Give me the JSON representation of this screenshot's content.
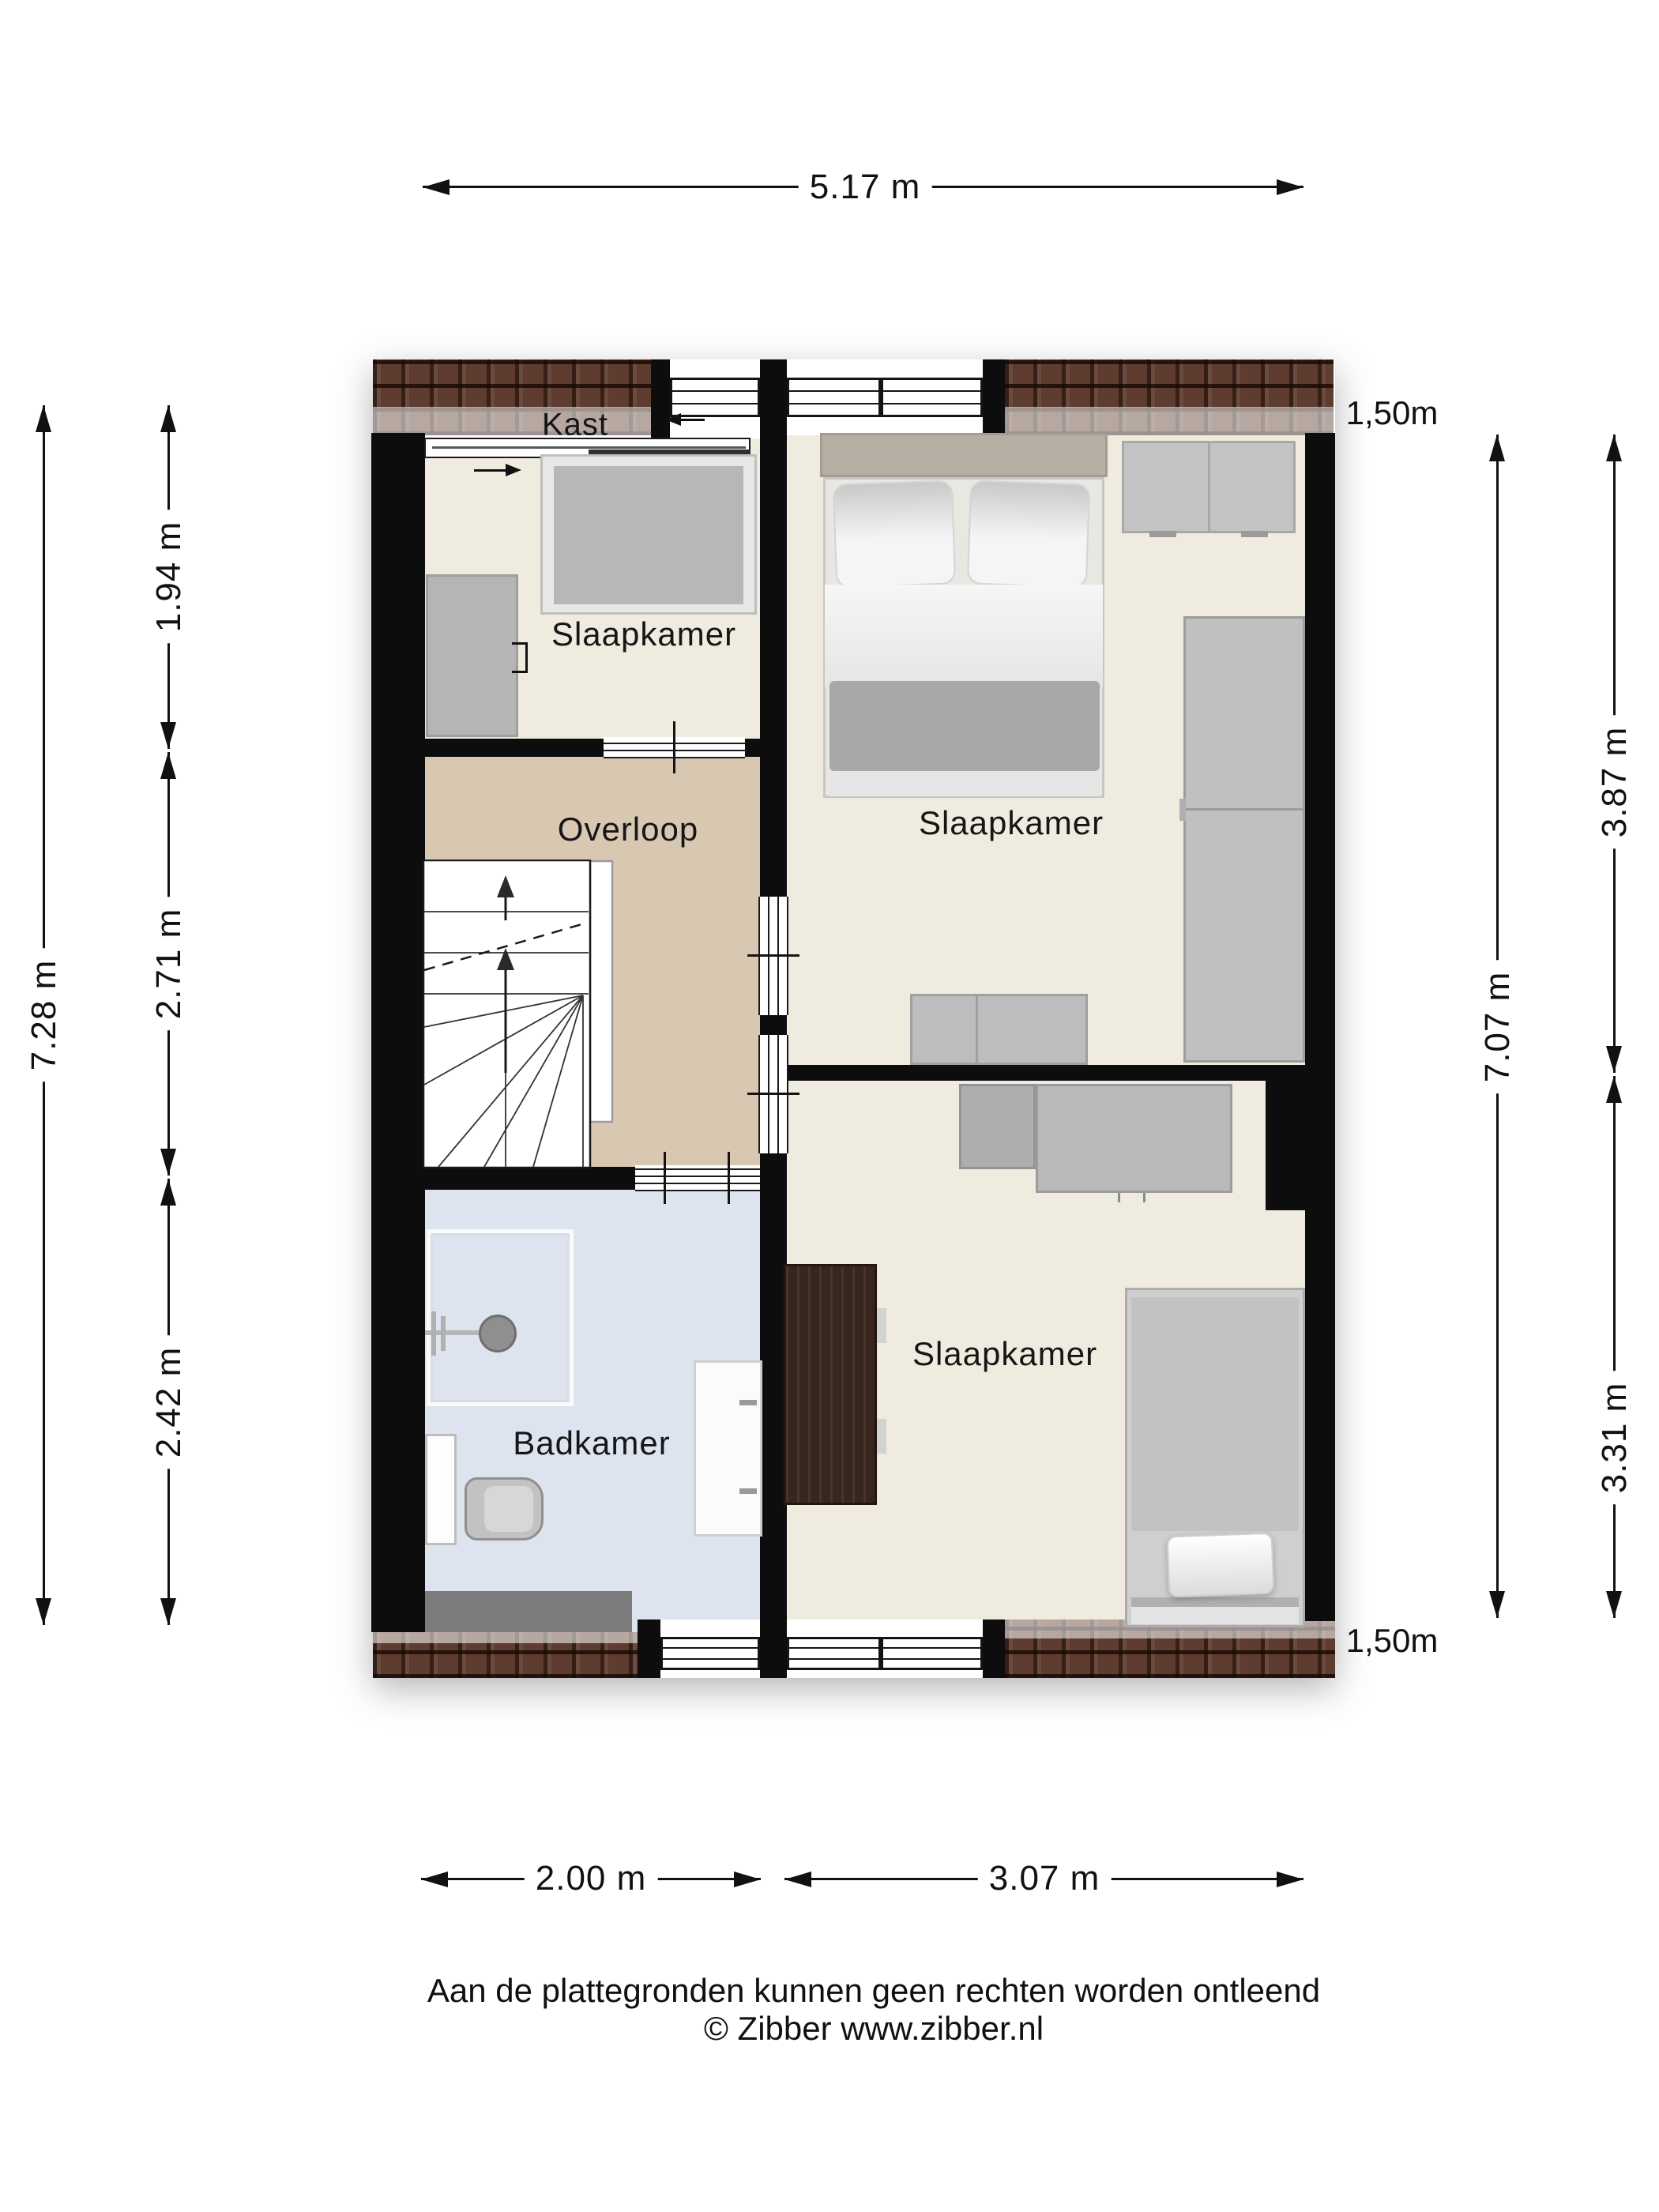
{
  "plan": {
    "type": "floorplan-first-floor",
    "rooms": {
      "kast": {
        "label": "Kast"
      },
      "slaapkamer_left": {
        "label": "Slaapkamer"
      },
      "slaapkamer_top_right": {
        "label": "Slaapkamer"
      },
      "overloop": {
        "label": "Overloop"
      },
      "badkamer": {
        "label": "Badkamer"
      },
      "slaapkamer_bottom_right": {
        "label": "Slaapkamer"
      }
    },
    "colors": {
      "wall": "#0d0d0d",
      "bedroom_floor": "#efebdf",
      "landing_floor": "#d8c8b2",
      "bathroom_floor": "#dee4ef",
      "roof_tiles": "#5e3c2f",
      "furniture_gray": "#b5b5b5",
      "dark_cabinet": "#37261d"
    }
  },
  "dimensions": {
    "top_width": "5.17 m",
    "left_total": "7.28 m",
    "left_segments": [
      "1.94 m",
      "2.71 m",
      "2.42 m"
    ],
    "right_total": "7.07 m",
    "right_segments": [
      "3.87 m",
      "3.31 m"
    ],
    "knee_wall_top": "1,50m",
    "knee_wall_bottom": "1,50m",
    "bottom_segments": [
      "2.00 m",
      "3.07 m"
    ]
  },
  "footer": {
    "line1": "Aan de plattegronden kunnen geen rechten worden ontleend",
    "line2": "© Zibber www.zibber.nl"
  }
}
